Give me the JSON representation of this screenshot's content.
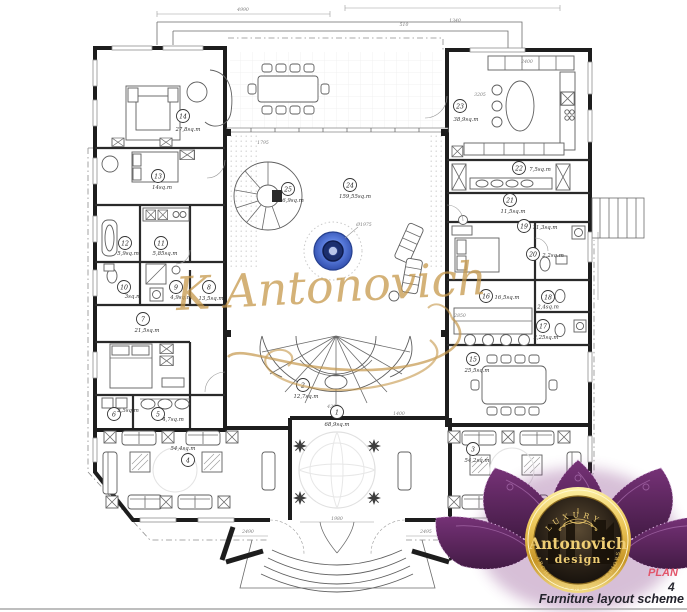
{
  "title": {
    "plan_label": "PLAN",
    "sheet_number": "4",
    "caption": "Furniture layout scheme"
  },
  "watermark": {
    "text": "K Antonovich",
    "color": "#c6984c"
  },
  "fountain": {
    "name": "fountain",
    "label": "Ø1975",
    "ring_color": "#3f62c9",
    "core_color": "#1c2f6e"
  },
  "logo": {
    "top": "LUXURY",
    "name": "Antonovich",
    "sub": "· design ·",
    "bottom": "ARCHITECTURE & INTERIORS",
    "petal_color": "#5f2a60",
    "ring_color": "#e7c35a"
  },
  "rooms": [
    {
      "number": "1",
      "area": "68,9sq.m"
    },
    {
      "number": "2",
      "area": "12,7sq.m"
    },
    {
      "number": "3",
      "area": "54,2sq.m"
    },
    {
      "number": "4",
      "area": "54,4sq.m"
    },
    {
      "number": "5",
      "area": "4,7sq.m"
    },
    {
      "number": "6",
      "area": "2,5sq.m"
    },
    {
      "number": "7",
      "area": "21,5sq.m"
    },
    {
      "number": "8",
      "area": "13,5sq.m"
    },
    {
      "number": "9",
      "area": "4,9sq.m"
    },
    {
      "number": "10",
      "area": "3sq.m"
    },
    {
      "number": "11",
      "area": "5,85sq.m"
    },
    {
      "number": "12",
      "area": "5,9sq.m"
    },
    {
      "number": "13",
      "area": "14sq.m"
    },
    {
      "number": "14",
      "area": "27,8sq.m"
    },
    {
      "number": "15",
      "area": "25,5sq.m"
    },
    {
      "number": "16",
      "area": "16,5sq.m"
    },
    {
      "number": "17",
      "area": "2,25sq.m"
    },
    {
      "number": "18",
      "area": "2,4sq.m"
    },
    {
      "number": "19",
      "area": "11,3sq.m"
    },
    {
      "number": "20",
      "area": "2,2sq.m"
    },
    {
      "number": "21",
      "area": "11,5sq.m"
    },
    {
      "number": "22",
      "area": "7,5sq.m"
    },
    {
      "number": "23",
      "area": "38,9sq.m"
    },
    {
      "number": "24",
      "area": "159,55sq.m"
    },
    {
      "number": "25",
      "area": "6,9sq.m"
    }
  ],
  "dimensions": [
    "4990",
    "510",
    "1340",
    "3205",
    "2400",
    "1795",
    "2850",
    "4300",
    "1400",
    "1980",
    "2490",
    "2495",
    "Ø1975"
  ]
}
